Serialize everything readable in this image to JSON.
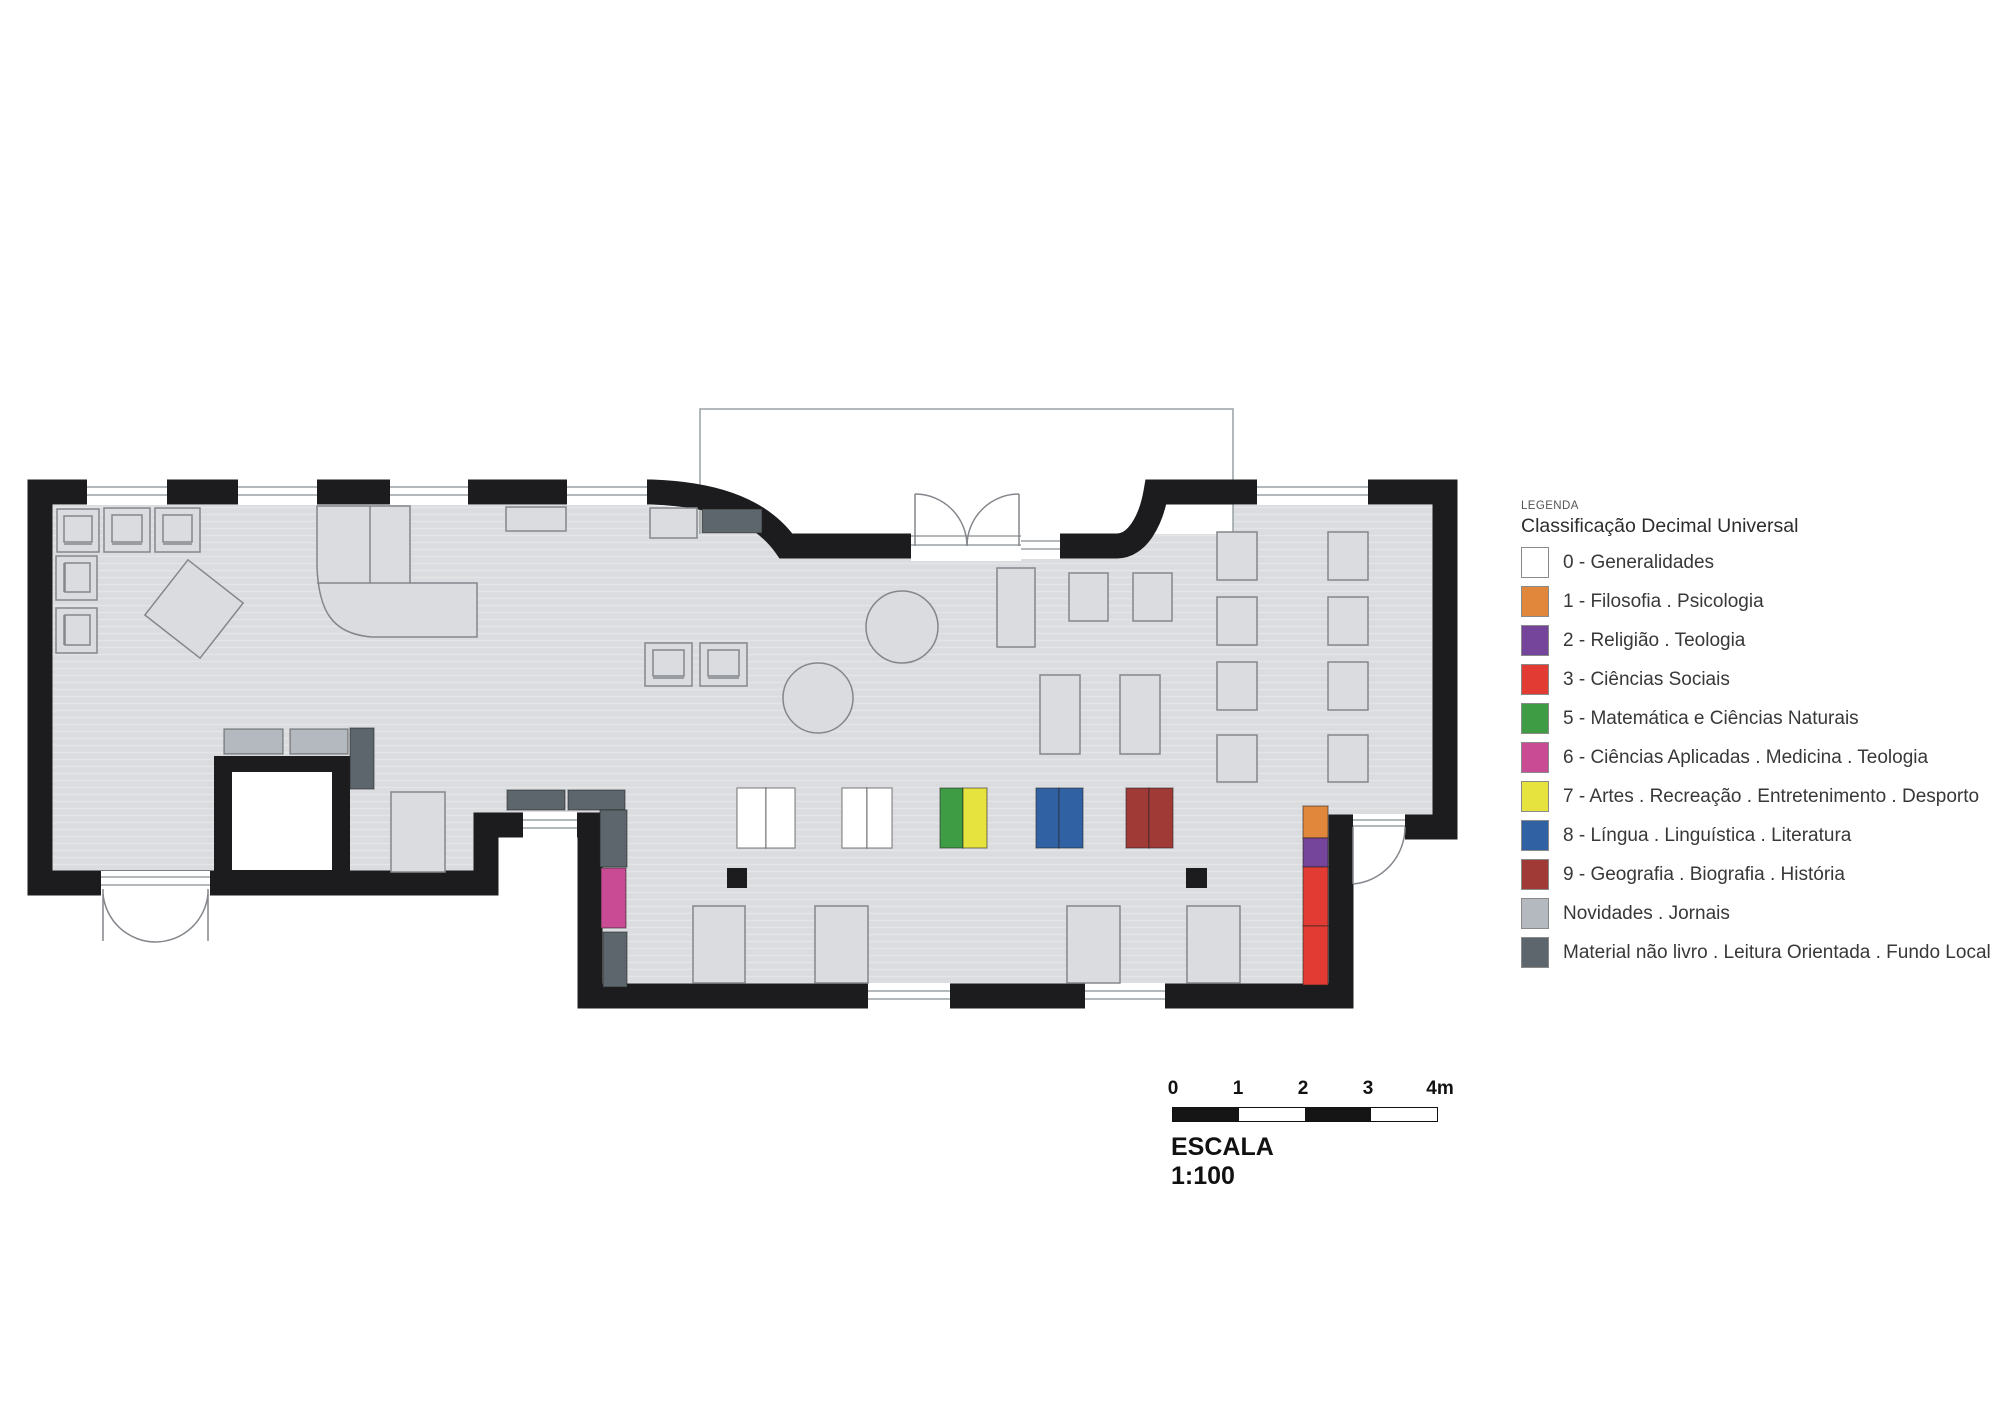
{
  "legend": {
    "heading": "LEGENDA",
    "title": "Classificação Decimal Universal",
    "items": [
      {
        "key": "white",
        "label": "0 - Generalidades",
        "color": "#ffffff"
      },
      {
        "key": "orange",
        "label": "1 - Filosofia . Psicologia",
        "color": "#e0873b"
      },
      {
        "key": "purple",
        "label": "2 - Religião . Teologia",
        "color": "#74459a"
      },
      {
        "key": "red",
        "label": "3 - Ciências Sociais",
        "color": "#e23b33"
      },
      {
        "key": "green",
        "label": "5 - Matemática e Ciências Naturais",
        "color": "#3d9c44"
      },
      {
        "key": "magenta",
        "label": "6 - Ciências Aplicadas . Medicina . Teologia",
        "color": "#c84b94"
      },
      {
        "key": "yellow",
        "label": "7 - Artes . Recreação . Entretenimento . Desporto",
        "color": "#e7e33e"
      },
      {
        "key": "blue",
        "label": "8 - Língua . Linguística . Literatura",
        "color": "#3061a3"
      },
      {
        "key": "darkred",
        "label": "9 - Geografia . Biografia . História",
        "color": "#a03a36"
      },
      {
        "key": "lightgray",
        "label": "Novidades . Jornais",
        "color": "#b4b8bf"
      },
      {
        "key": "slate",
        "label": "Material não livro . Leitura Orientada . Fundo Local",
        "color": "#5d666d"
      }
    ]
  },
  "scale": {
    "ticks": [
      "0",
      "1",
      "2",
      "3",
      "4m"
    ],
    "label": "ESCALA 1:100"
  },
  "plan": {
    "wall_color": "#1c1c1e",
    "floor_color": "#dbdcdf",
    "outline_color": "#83868b"
  }
}
